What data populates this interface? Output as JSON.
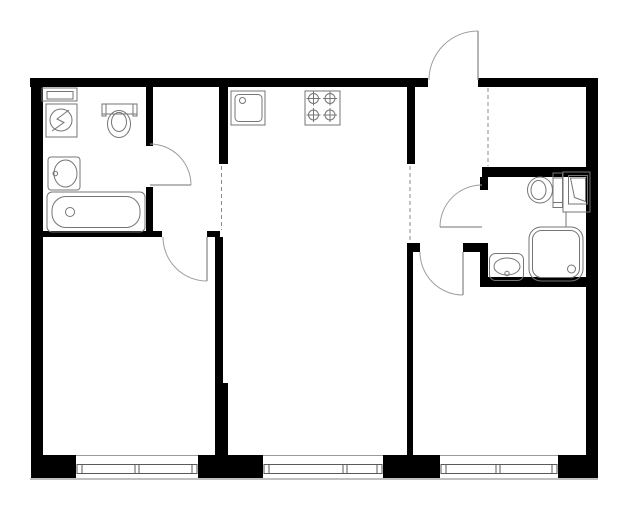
{
  "canvas": {
    "width": 629,
    "height": 512,
    "background": "#ffffff"
  },
  "colors": {
    "wall": "#000000",
    "fixture": "#757575",
    "door": "#9e9e9e",
    "dash": "#8a8a8a",
    "window_frame": "#5a5a5a",
    "window_face": "#9a9a9a",
    "outer_line": "#aaaaaa",
    "white": "#ffffff"
  },
  "walls": [
    {
      "name": "outer-wall-top-left-segment",
      "x": 30,
      "y": 78,
      "w": 398,
      "h": 9
    },
    {
      "name": "outer-wall-top-right-segment",
      "x": 478,
      "y": 78,
      "w": 120,
      "h": 9
    },
    {
      "name": "outer-wall-left",
      "x": 31,
      "y": 78,
      "w": 12,
      "h": 400
    },
    {
      "name": "outer-wall-right",
      "x": 586,
      "y": 78,
      "w": 12,
      "h": 400
    },
    {
      "name": "outer-wall-bottom-pier-1",
      "x": 31,
      "y": 455,
      "w": 45,
      "h": 23
    },
    {
      "name": "outer-wall-bottom-pier-2",
      "x": 198,
      "y": 455,
      "w": 65,
      "h": 23
    },
    {
      "name": "outer-wall-bottom-pier-3",
      "x": 383,
      "y": 455,
      "w": 57,
      "h": 23
    },
    {
      "name": "outer-wall-bottom-pier-4",
      "x": 558,
      "y": 455,
      "w": 40,
      "h": 23
    },
    {
      "name": "bathroom1-right-wall-upper",
      "x": 146,
      "y": 87,
      "w": 7,
      "h": 59
    },
    {
      "name": "bathroom1-right-wall-lower",
      "x": 146,
      "y": 187,
      "w": 7,
      "h": 50
    },
    {
      "name": "bathroom1-bottom-wall",
      "x": 43,
      "y": 231,
      "w": 119,
      "h": 6
    },
    {
      "name": "left-room-door-jamb-stub",
      "x": 207,
      "y": 231,
      "w": 13,
      "h": 6
    },
    {
      "name": "left-room-right-wall-upper",
      "x": 215,
      "y": 237,
      "w": 8,
      "h": 146
    },
    {
      "name": "left-room-right-wall-lower",
      "x": 215,
      "y": 383,
      "w": 13,
      "h": 72
    },
    {
      "name": "kitchen-left-wall",
      "x": 219,
      "y": 87,
      "w": 9,
      "h": 77
    },
    {
      "name": "kitchen-right-wall",
      "x": 407,
      "y": 87,
      "w": 8,
      "h": 77
    },
    {
      "name": "hallway-door-stub-left",
      "x": 407,
      "y": 243,
      "w": 13,
      "h": 9
    },
    {
      "name": "hallway-door-stub-right",
      "x": 463,
      "y": 243,
      "w": 19,
      "h": 9
    },
    {
      "name": "middle-right-room-divider-wall",
      "x": 407,
      "y": 252,
      "w": 6,
      "h": 203
    },
    {
      "name": "bathroom2-top-wall",
      "x": 482,
      "y": 167,
      "w": 116,
      "h": 10
    },
    {
      "name": "bathroom2-left-wall-upper",
      "x": 480,
      "y": 177,
      "w": 8,
      "h": 13
    },
    {
      "name": "bathroom2-left-wall-lower",
      "x": 480,
      "y": 243,
      "w": 8,
      "h": 44
    },
    {
      "name": "bathroom2-bottom-wall",
      "x": 482,
      "y": 277,
      "w": 116,
      "h": 10
    }
  ],
  "dashed_boundaries": [
    {
      "name": "kitchen-zone-boundary-left",
      "x1": 221.5,
      "y1": 166,
      "x2": 221.5,
      "y2": 230
    },
    {
      "name": "kitchen-zone-boundary-right",
      "x1": 410,
      "y1": 166,
      "x2": 410,
      "y2": 242
    },
    {
      "name": "hallway-niche-boundary",
      "x1": 488,
      "y1": 88,
      "x2": 488,
      "y2": 166
    }
  ],
  "doors": [
    {
      "name": "entrance-door",
      "leaf": "M478,31 L478,80",
      "arc": "M478,31 A49,49 0 0 0 429,80"
    },
    {
      "name": "bathroom1-door",
      "leaf": "M150,185 L191,185",
      "arc": "M191,185 A41,41 0 0 0 150,144"
    },
    {
      "name": "bathroom2-door",
      "leaf": "M440,227 L482,227",
      "arc": "M440,227 A42,42 0 0 1 482,185"
    },
    {
      "name": "left-room-door",
      "leaf": "M207,237 L207,281",
      "arc": "M207,281 A44,44 0 0 1 163,237"
    },
    {
      "name": "right-room-door",
      "leaf": "M463,252 L463,295",
      "arc": "M463,295 A43,43 0 0 1 420,252"
    }
  ],
  "window_style": {
    "top": 455,
    "bottom": 478,
    "frame_y": 464.5,
    "frame_h": 9,
    "cap_w": 5,
    "sill_y": 479
  },
  "windows": [
    {
      "name": "left-room-window",
      "x1": 76,
      "x2": 198,
      "mullion": 137
    },
    {
      "name": "middle-room-window",
      "x1": 263,
      "x2": 383,
      "mullion": 345
    },
    {
      "name": "right-room-window",
      "x1": 440,
      "x2": 558,
      "mullion": 498
    }
  ],
  "fixtures": [
    {
      "name": "bathroom1-shelf",
      "shapes": [
        {
          "kind": "rect",
          "x": 42,
          "y": 88,
          "w": 35,
          "h": 13
        },
        {
          "kind": "rect",
          "x": 47,
          "y": 91.5,
          "w": 26,
          "h": 7.5
        }
      ]
    },
    {
      "name": "washing-machine",
      "shapes": [
        {
          "kind": "rect",
          "x": 46,
          "y": 104,
          "w": 31,
          "h": 33
        },
        {
          "kind": "circle",
          "cx": 61,
          "cy": 120,
          "r": 11
        },
        {
          "kind": "path",
          "d": "M69,110 L57,119 L64,122.5 L52,131"
        }
      ]
    },
    {
      "name": "toilet-bathroom1",
      "shapes": [
        {
          "kind": "rect",
          "x": 102,
          "y": 104,
          "w": 35,
          "h": 10
        },
        {
          "kind": "rect",
          "x": 102,
          "y": 104,
          "w": 4,
          "h": 12
        },
        {
          "kind": "rect",
          "x": 133,
          "y": 104,
          "w": 4,
          "h": 12
        },
        {
          "kind": "ellipse",
          "cx": 119,
          "cy": 124,
          "rx": 11.5,
          "ry": 13.5
        },
        {
          "kind": "ellipse",
          "cx": 119,
          "cy": 122,
          "rx": 7.5,
          "ry": 9.5
        }
      ]
    },
    {
      "name": "washbasin-bathroom1",
      "shapes": [
        {
          "kind": "rect",
          "x": 48,
          "y": 157,
          "w": 32,
          "h": 33,
          "rx": 3
        },
        {
          "kind": "ellipse",
          "cx": 65.5,
          "cy": 173.5,
          "rx": 11.5,
          "ry": 13.5
        },
        {
          "kind": "circle",
          "cx": 55.3,
          "cy": 173.5,
          "r": 2.3
        }
      ]
    },
    {
      "name": "bathtub",
      "shapes": [
        {
          "kind": "rect",
          "x": 47,
          "y": 192,
          "w": 98,
          "h": 40,
          "rx": 5
        },
        {
          "kind": "rect",
          "x": 52,
          "y": 196.5,
          "w": 88,
          "h": 31,
          "rx": 14
        },
        {
          "kind": "circle",
          "cx": 70,
          "cy": 212,
          "r": 4.5
        }
      ]
    },
    {
      "name": "kitchen-sink",
      "shapes": [
        {
          "kind": "rect",
          "x": 231,
          "y": 91,
          "w": 34,
          "h": 34
        },
        {
          "kind": "rect",
          "x": 235,
          "y": 94.5,
          "w": 27,
          "h": 27,
          "rx": 4
        },
        {
          "kind": "circle",
          "cx": 242.5,
          "cy": 100.5,
          "r": 3
        }
      ]
    },
    {
      "name": "stove",
      "shapes": [
        {
          "kind": "rect",
          "x": 305,
          "y": 91,
          "w": 35,
          "h": 34
        },
        {
          "kind": "circle",
          "cx": 313.5,
          "cy": 98.5,
          "r": 5
        },
        {
          "kind": "line",
          "x1": 306.5,
          "y1": 98.5,
          "x2": 320.5,
          "y2": 98.5
        },
        {
          "kind": "line",
          "x1": 313.5,
          "y1": 91.5,
          "x2": 313.5,
          "y2": 105.5
        },
        {
          "kind": "circle",
          "cx": 330,
          "cy": 98.5,
          "r": 5
        },
        {
          "kind": "line",
          "x1": 323,
          "y1": 98.5,
          "x2": 337,
          "y2": 98.5
        },
        {
          "kind": "line",
          "x1": 330,
          "y1": 91.5,
          "x2": 330,
          "y2": 105.5
        },
        {
          "kind": "circle",
          "cx": 313.5,
          "cy": 115,
          "r": 5
        },
        {
          "kind": "line",
          "x1": 306.5,
          "y1": 115,
          "x2": 320.5,
          "y2": 115
        },
        {
          "kind": "line",
          "x1": 313.5,
          "y1": 108,
          "x2": 313.5,
          "y2": 122
        },
        {
          "kind": "circle",
          "cx": 330,
          "cy": 115,
          "r": 5
        },
        {
          "kind": "line",
          "x1": 323,
          "y1": 115,
          "x2": 337,
          "y2": 115
        },
        {
          "kind": "line",
          "x1": 330,
          "y1": 108,
          "x2": 330,
          "y2": 122
        }
      ]
    },
    {
      "name": "toilet-bathroom2",
      "shapes": [
        {
          "kind": "ellipse",
          "cx": 540,
          "cy": 190,
          "rx": 12.5,
          "ry": 13
        },
        {
          "kind": "ellipse",
          "cx": 538.5,
          "cy": 190,
          "rx": 7.5,
          "ry": 9.5
        },
        {
          "kind": "rect",
          "x": 553,
          "y": 173,
          "w": 9.5,
          "h": 34.5
        },
        {
          "kind": "line",
          "x1": 553,
          "y1": 178,
          "x2": 562.5,
          "y2": 178
        },
        {
          "kind": "line",
          "x1": 553,
          "y1": 202.5,
          "x2": 562.5,
          "y2": 202.5
        }
      ]
    },
    {
      "name": "water-heater",
      "shapes": [
        {
          "kind": "rect",
          "x": 563,
          "y": 172,
          "w": 27,
          "h": 40
        },
        {
          "kind": "rect",
          "x": 568.5,
          "y": 175.5,
          "w": 19,
          "h": 28.5
        },
        {
          "kind": "path",
          "d": "M570.5,178 L585.5,178 L585.5,201.5 L574.5,197.5 Z"
        },
        {
          "kind": "line",
          "x1": 566,
          "y1": 212,
          "x2": 566,
          "y2": 227
        }
      ]
    },
    {
      "name": "shower-tray",
      "shapes": [
        {
          "kind": "rect",
          "x": 529,
          "y": 227,
          "w": 54,
          "h": 54,
          "rx": 12
        },
        {
          "kind": "rect",
          "x": 532.5,
          "y": 230.5,
          "w": 47,
          "h": 47,
          "rx": 9
        },
        {
          "kind": "circle",
          "cx": 571.5,
          "cy": 269,
          "r": 4
        }
      ]
    },
    {
      "name": "washbasin-bathroom2",
      "shapes": [
        {
          "kind": "rect",
          "x": 489.5,
          "y": 253.5,
          "w": 34,
          "h": 27,
          "rx": 6
        },
        {
          "kind": "ellipse",
          "cx": 507,
          "cy": 266.5,
          "rx": 13,
          "ry": 8.5
        },
        {
          "kind": "circle",
          "cx": 507,
          "cy": 273.5,
          "r": 2.2
        }
      ]
    }
  ]
}
